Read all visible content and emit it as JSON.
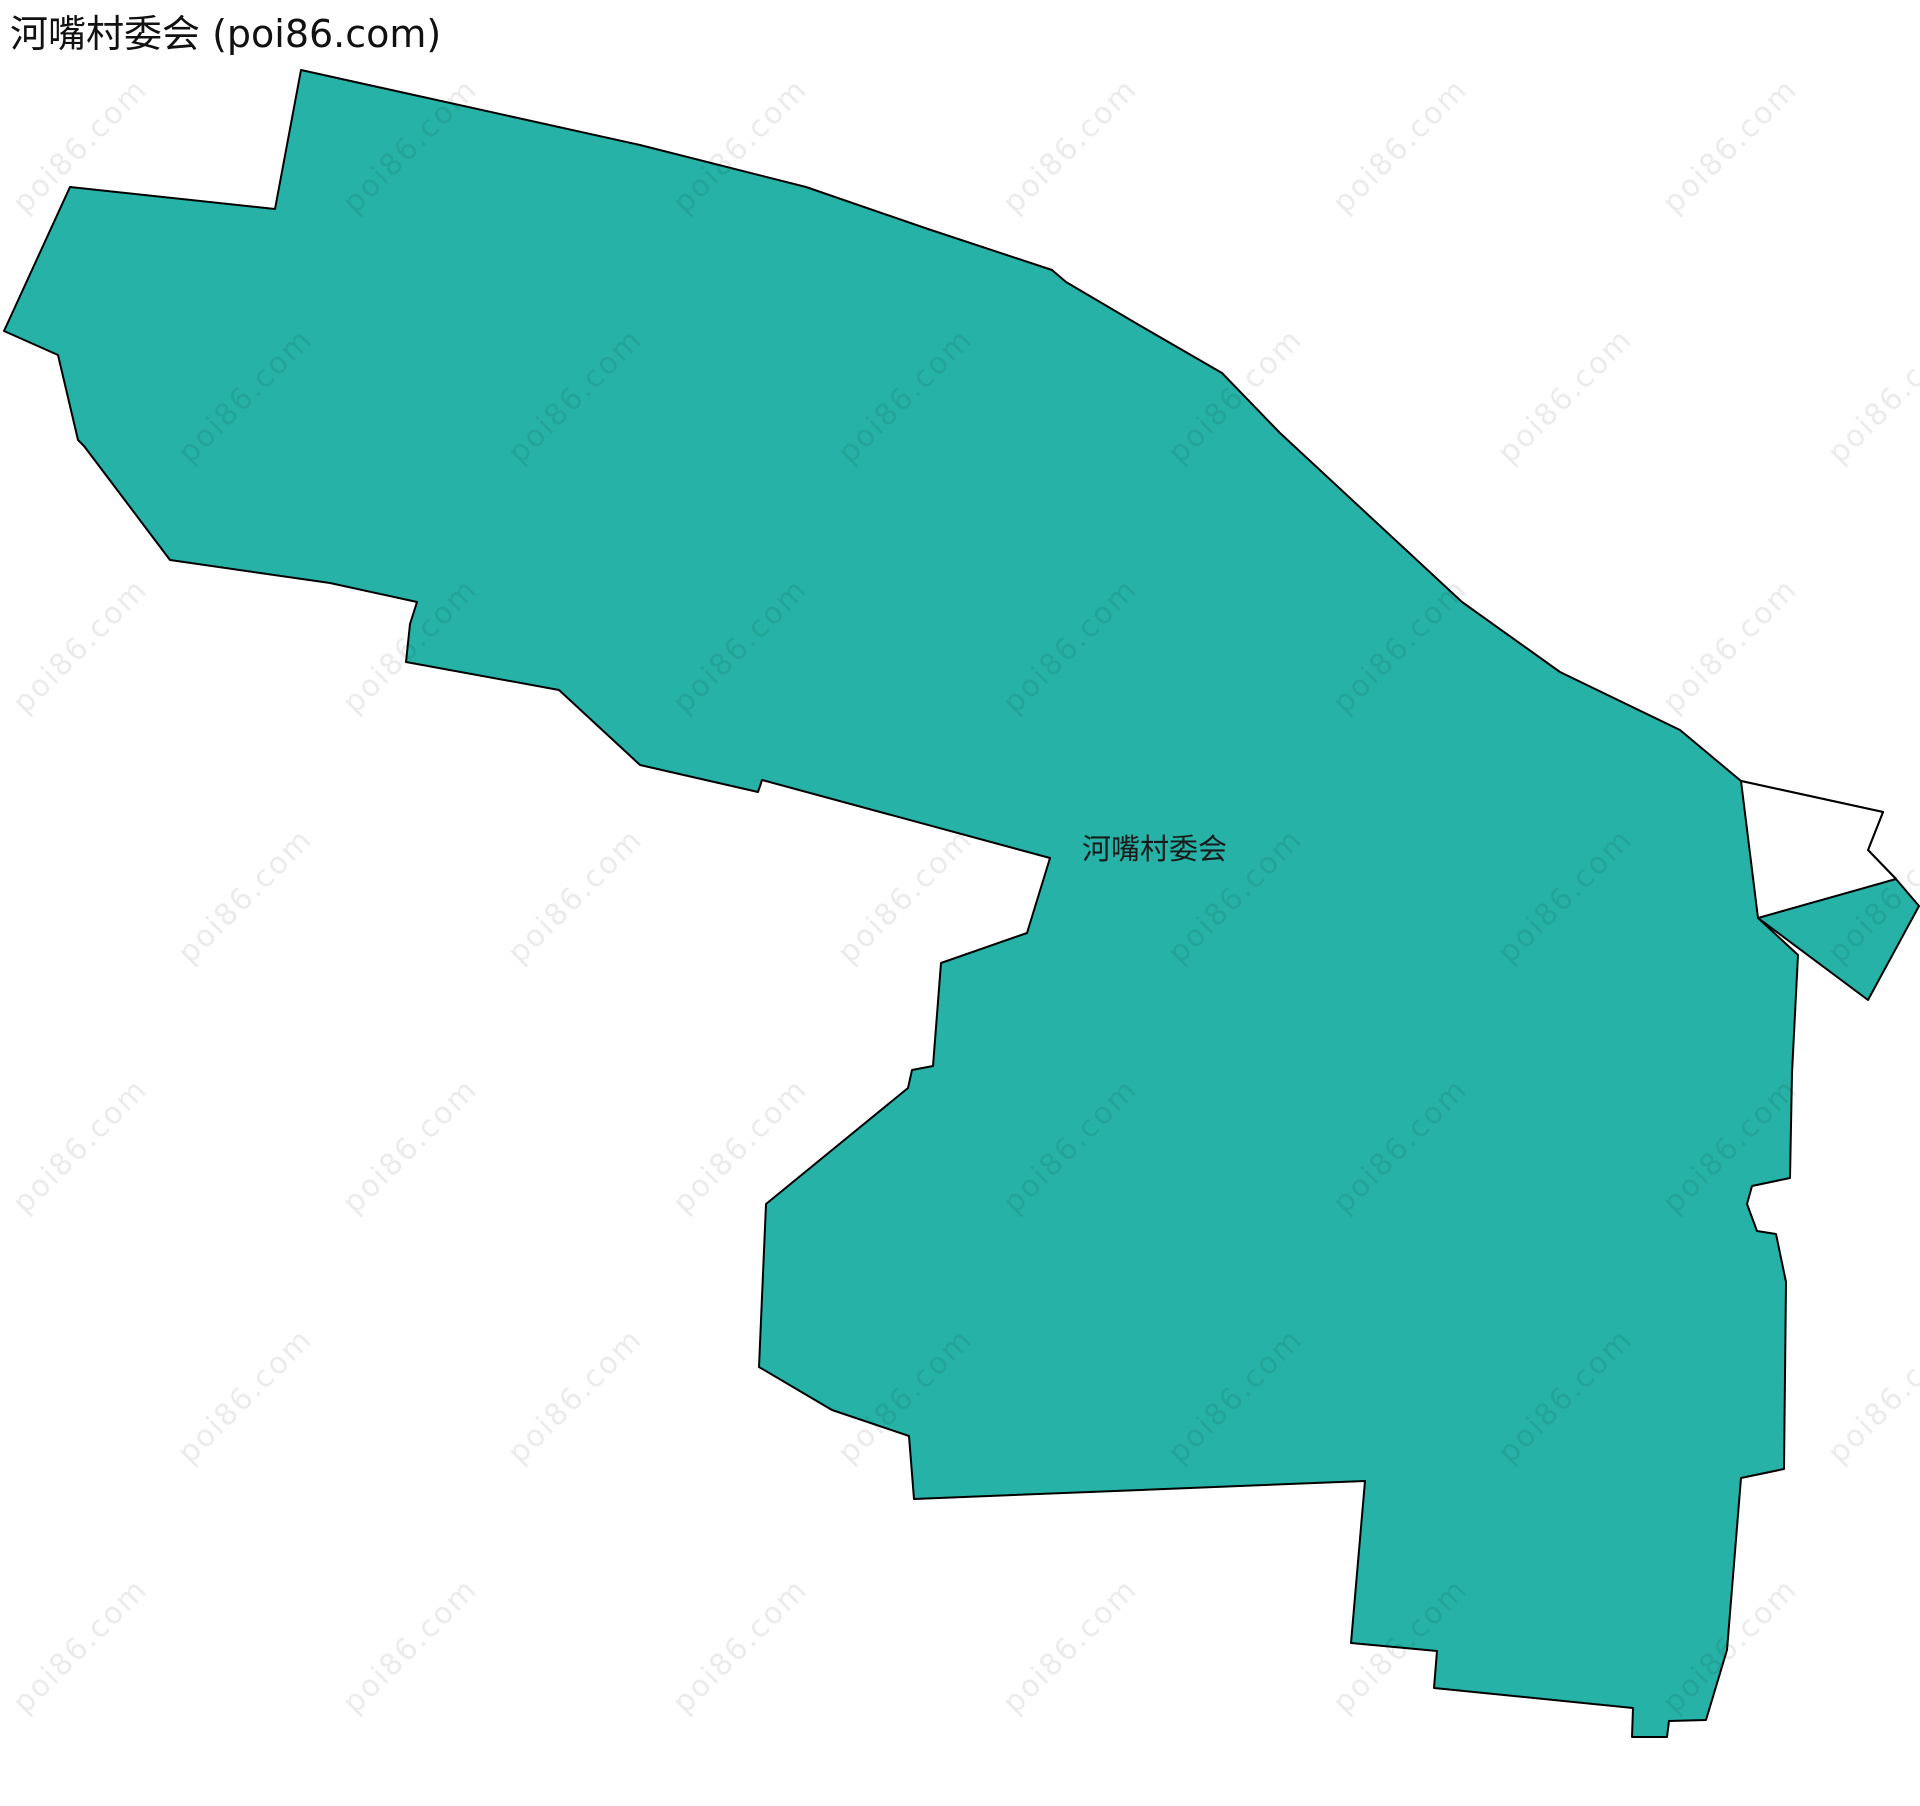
{
  "page": {
    "title": "河嘴村委会 (poi86.com)"
  },
  "map": {
    "region_label": "河嘴村委会",
    "watermark_text": "poi86.com",
    "region_points": "301,70 640,145 806,187 928,229 1052,270 1066,282 1139,325 1222,373 1280,433 1462,602 1560,672 1680,730 1741,781 1883,812 1868,850 1896,879 1919,906 1868,1000 1758,918 1798,955 1792,1073 1790,1178 1752,1186 1747,1204 1757,1231 1776,1234 1786,1282 1784,1469 1741,1478 1727,1650 1706,1720 1669,1721 1667,1737 1632,1737 1633,1708 1434,1688 1437,1651 1351,1643 1365,1481 914,1499 909,1436 832,1410 759,1367 766,1204 908,1088 912,1070 933,1066 941,963 1027,933 1050,858 762,780 758,792 640,765 559,690 406,662 410,624 417,602 330,583 170,560 84,446 78,440 58,355 4,331 70,187 275,209",
    "sliver_points": "1741,781 1883,812 1868,850 1896,879 1758,918",
    "colors": {
      "region_fill": "#26b2a6",
      "region_stroke": "#000000",
      "background": "#ffffff",
      "watermark": "rgba(0,0,0,0.08)",
      "label": "#1a1a1a",
      "title": "#111111"
    }
  }
}
